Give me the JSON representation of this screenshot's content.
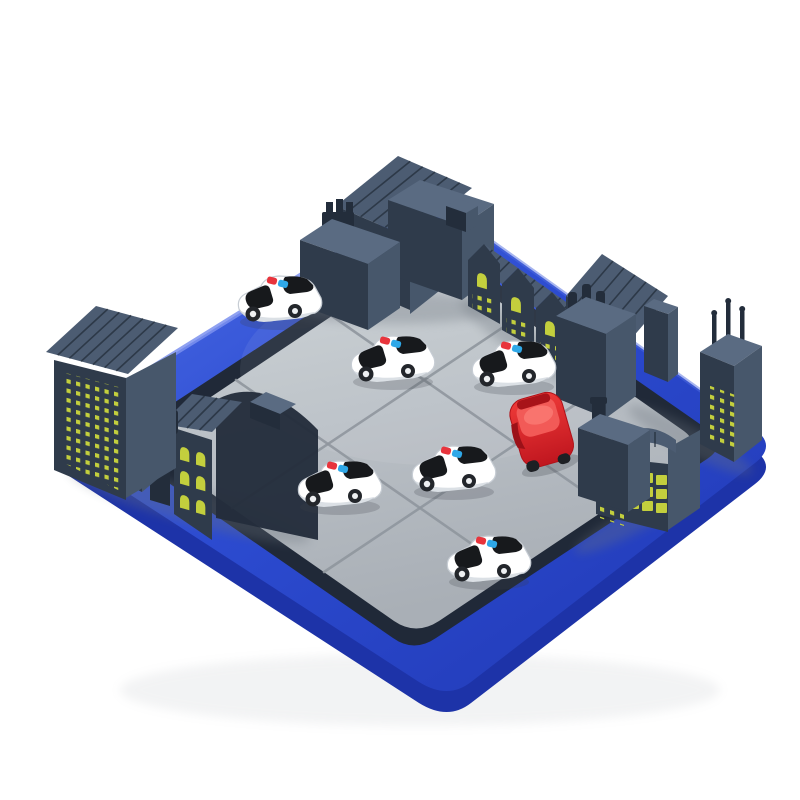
{
  "scene": {
    "type": "product-photo",
    "subject": "Road-block sliding puzzle board game: grey city buildings around a blue tray, six white police cars surrounding one red car",
    "background_color": "#ffffff",
    "board": {
      "tray_shape": "rounded-square blue tray seen in diamond perspective",
      "surface": "large interlocking light-grey puzzle tiles",
      "grid": "6x6",
      "visible_tile_pieces": 9
    },
    "vehicles": {
      "police_cars": {
        "count": 6,
        "body_color": "#ffffff",
        "windshield_color": "#17191c",
        "roof_light_colors": [
          "#e8343c",
          "#2fa8e8"
        ]
      },
      "red_car": {
        "count": 1,
        "body_color": "#e2202b"
      }
    },
    "buildings": {
      "count": 16,
      "window_color": "#c3cf3d",
      "clusters": [
        {
          "position": "top-corner",
          "items": [
            "ribbed-gable-hall",
            "tower-with-cog-chimney",
            "flat-roof-block-with-chimney"
          ]
        },
        {
          "position": "upper-right-edge",
          "items": [
            "sawtooth-factory-1",
            "sawtooth-factory-2",
            "sawtooth-factory-3",
            "large-hatched-gable",
            "tower-with-three-pipes",
            "thin-slab"
          ]
        },
        {
          "position": "right-corner",
          "items": [
            "high-rise-with-antennas"
          ]
        },
        {
          "position": "lower-right-edge",
          "items": [
            "barrel-roof-hall-with-window-grid",
            "block-with-chimney"
          ]
        },
        {
          "position": "left-edge",
          "items": [
            "high-rise-dot-windows",
            "annex-two-windows",
            "pipe-wall",
            "gable-arched-windows",
            "curved-roof-hall"
          ]
        }
      ]
    }
  },
  "colors": {
    "bg": "#ffffff",
    "tray": "#2c4bd0",
    "tray-light": "#5873e8",
    "tray-dark": "#1b2f9e",
    "tray-side": "#1d33a8",
    "groove": "#202938",
    "tile": "#b9bfc5",
    "tile-light": "#cad0d5",
    "tile-seam": "#8f969d",
    "bldg-front": "#2f3b4b",
    "bldg-side": "#47576b",
    "bldg-top": "#5a6b82",
    "bldg-dark": "#232d3b",
    "bldg-roof": "#4c5c72",
    "window": "#c3cf3d",
    "car-white": "#ffffff",
    "car-black": "#17191c",
    "light-red": "#e8343c",
    "light-blue": "#2fa8e8",
    "red-car": "#e2202b",
    "red-car-dark": "#a8141c",
    "red-car-light": "#f25a57"
  }
}
